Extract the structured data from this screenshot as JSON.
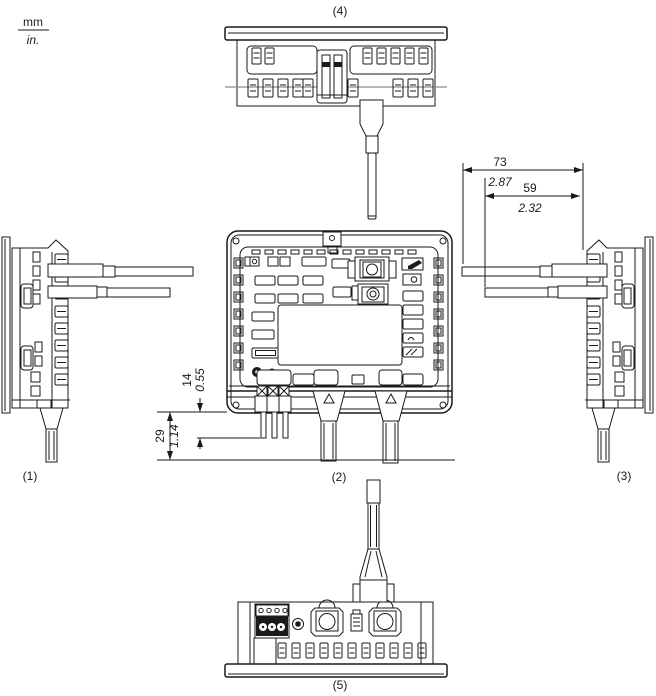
{
  "units": {
    "metric": "mm",
    "imperial": "in."
  },
  "views": {
    "left_side": {
      "label": "(1)"
    },
    "rear": {
      "label": "(2)"
    },
    "right_side": {
      "label": "(3)"
    },
    "top": {
      "label": "(4)"
    },
    "bottom": {
      "label": "(5)"
    }
  },
  "dimensions": {
    "terminal_block_depth": {
      "mm": "14",
      "in": "0.55"
    },
    "terminal_wires_depth": {
      "mm": "29",
      "in": "1.14"
    },
    "cable_clearance_outer": {
      "mm": "73",
      "in": "2.87"
    },
    "cable_clearance_inner": {
      "mm": "59",
      "in": "2.32"
    }
  },
  "colors": {
    "line": "#1a1a1a",
    "secondary_line": "#8c8c8c",
    "background": "#ffffff"
  }
}
